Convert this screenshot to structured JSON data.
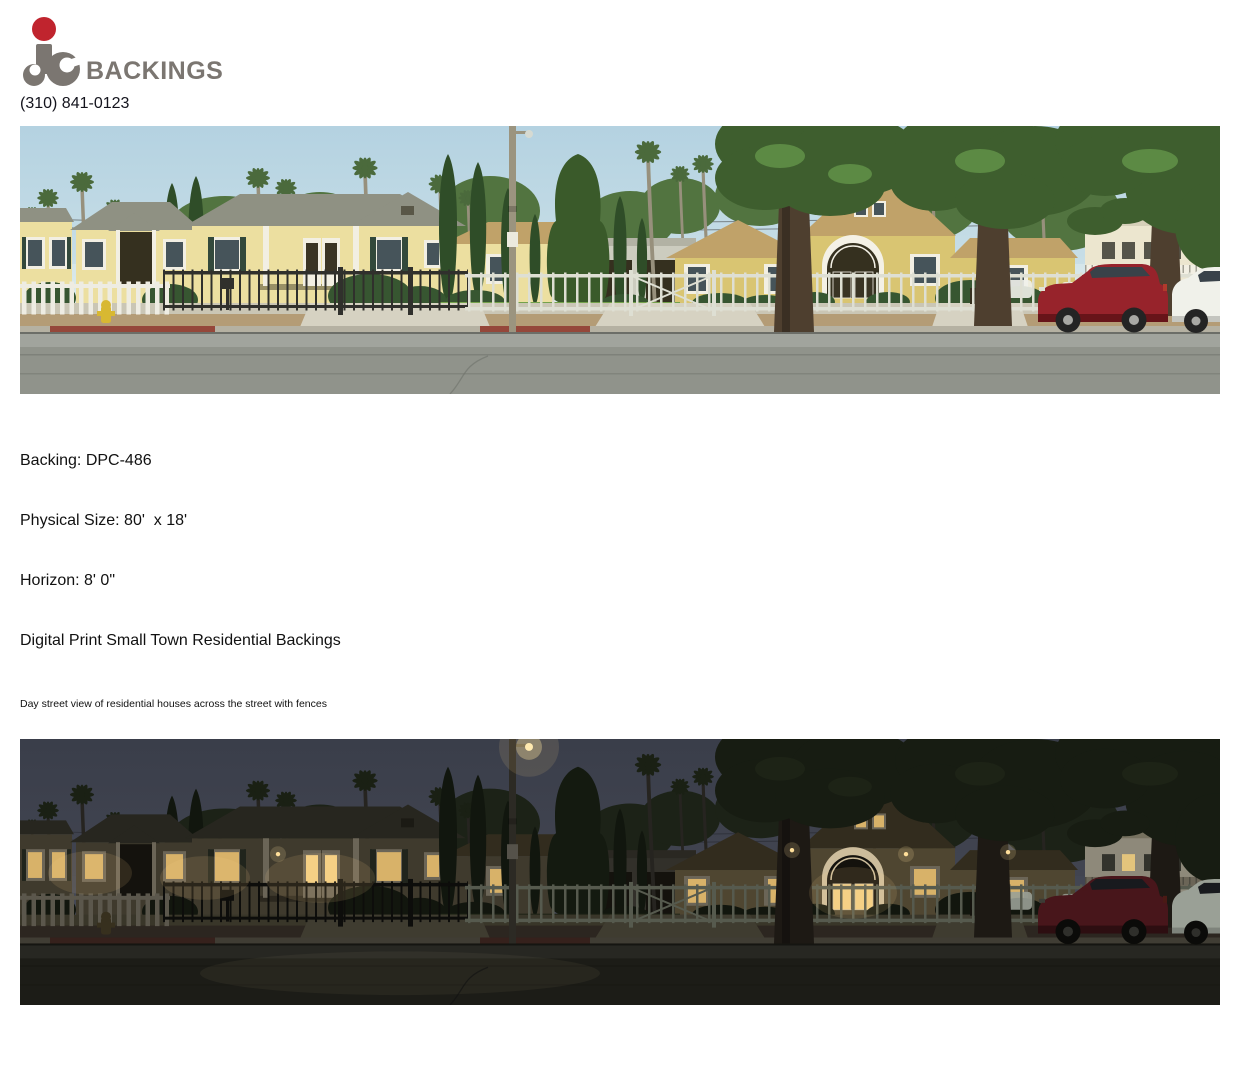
{
  "header": {
    "brand": "BACKINGS",
    "phone": "(310) 841-0123"
  },
  "product": {
    "backing": "Backing: DPC-486",
    "physical_size": "Physical Size: 80'  x 18'",
    "horizon": "Horizon: 8' 0\"",
    "category": "Digital Print Small Town Residential Backings",
    "description": "Day street view of residential houses across the street with fences"
  },
  "theme": {
    "logo_red": "#c0242e",
    "logo_gray": "#7b7671"
  }
}
